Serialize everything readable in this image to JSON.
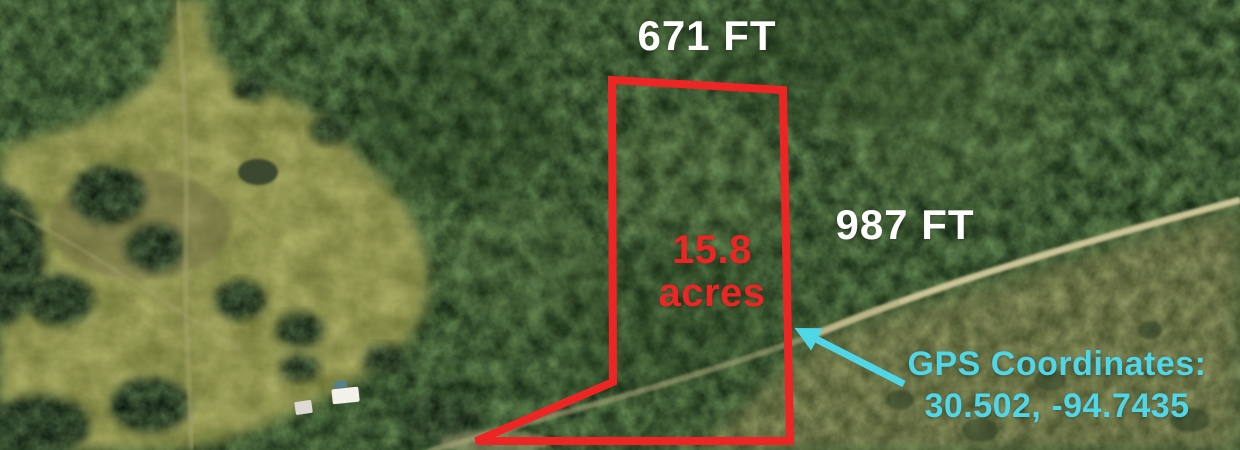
{
  "map": {
    "labels": {
      "top_dimension": "671 FT",
      "right_dimension": "987 FT",
      "acreage_value": "15.8",
      "acreage_unit": "acres",
      "gps_title": "GPS Coordinates:",
      "gps_value": "30.502, -94.7435"
    },
    "colors": {
      "boundary_red": "#ee2525",
      "accent_cyan": "#4fd6e7",
      "label_white": "#ffffff"
    }
  }
}
